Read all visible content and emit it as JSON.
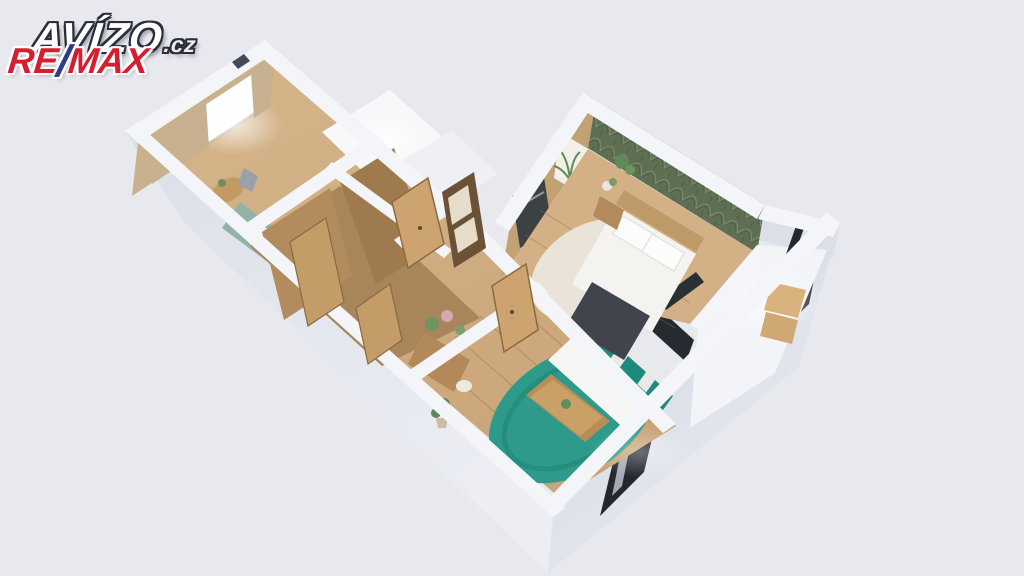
{
  "watermark": {
    "avizo": {
      "text": "AVÍZO",
      "tld": ".cz"
    },
    "remax": {
      "re": "RE",
      "slash": "/",
      "max": "MAX"
    }
  },
  "scene": {
    "type": "3d-floorplan-render",
    "rooms": [
      "kitchen-dining",
      "bathroom",
      "wc",
      "hallway",
      "living-room",
      "bedroom",
      "balcony"
    ]
  },
  "palette": {
    "bg": "#e8e9ee",
    "wallTop": "#f4f5f9",
    "wallFaceLight": "#eceef4",
    "wallFaceMid": "#dcdfe8",
    "wallFaceDark": "#cdd1dd",
    "floorWood": "#c9a478",
    "floorWoodLight": "#d6b68c",
    "woodPanel": "#a8855b",
    "woodDoor": "#cda46f",
    "woodFurniture": "#b98d58",
    "counterTeal": "#93b2a7",
    "rugTeal": "#2e9a8b",
    "pillowTeal": "#1e8a7c",
    "wallpaperGreen": "#5e6f53",
    "wallpaperLeaf": "#7d8f6d",
    "bedWhite": "#f4f3f0",
    "throwDark": "#40454d",
    "frameBlack": "#23272e",
    "curtainTan": "#c7b191",
    "rugCream": "#eae4d8",
    "plantGreen": "#5d8a55",
    "logoWhite": "#ffffff",
    "logoRed": "#d61f2e",
    "logoBlue": "#2b3e8c",
    "logoOutline": "#2b2e3a"
  }
}
